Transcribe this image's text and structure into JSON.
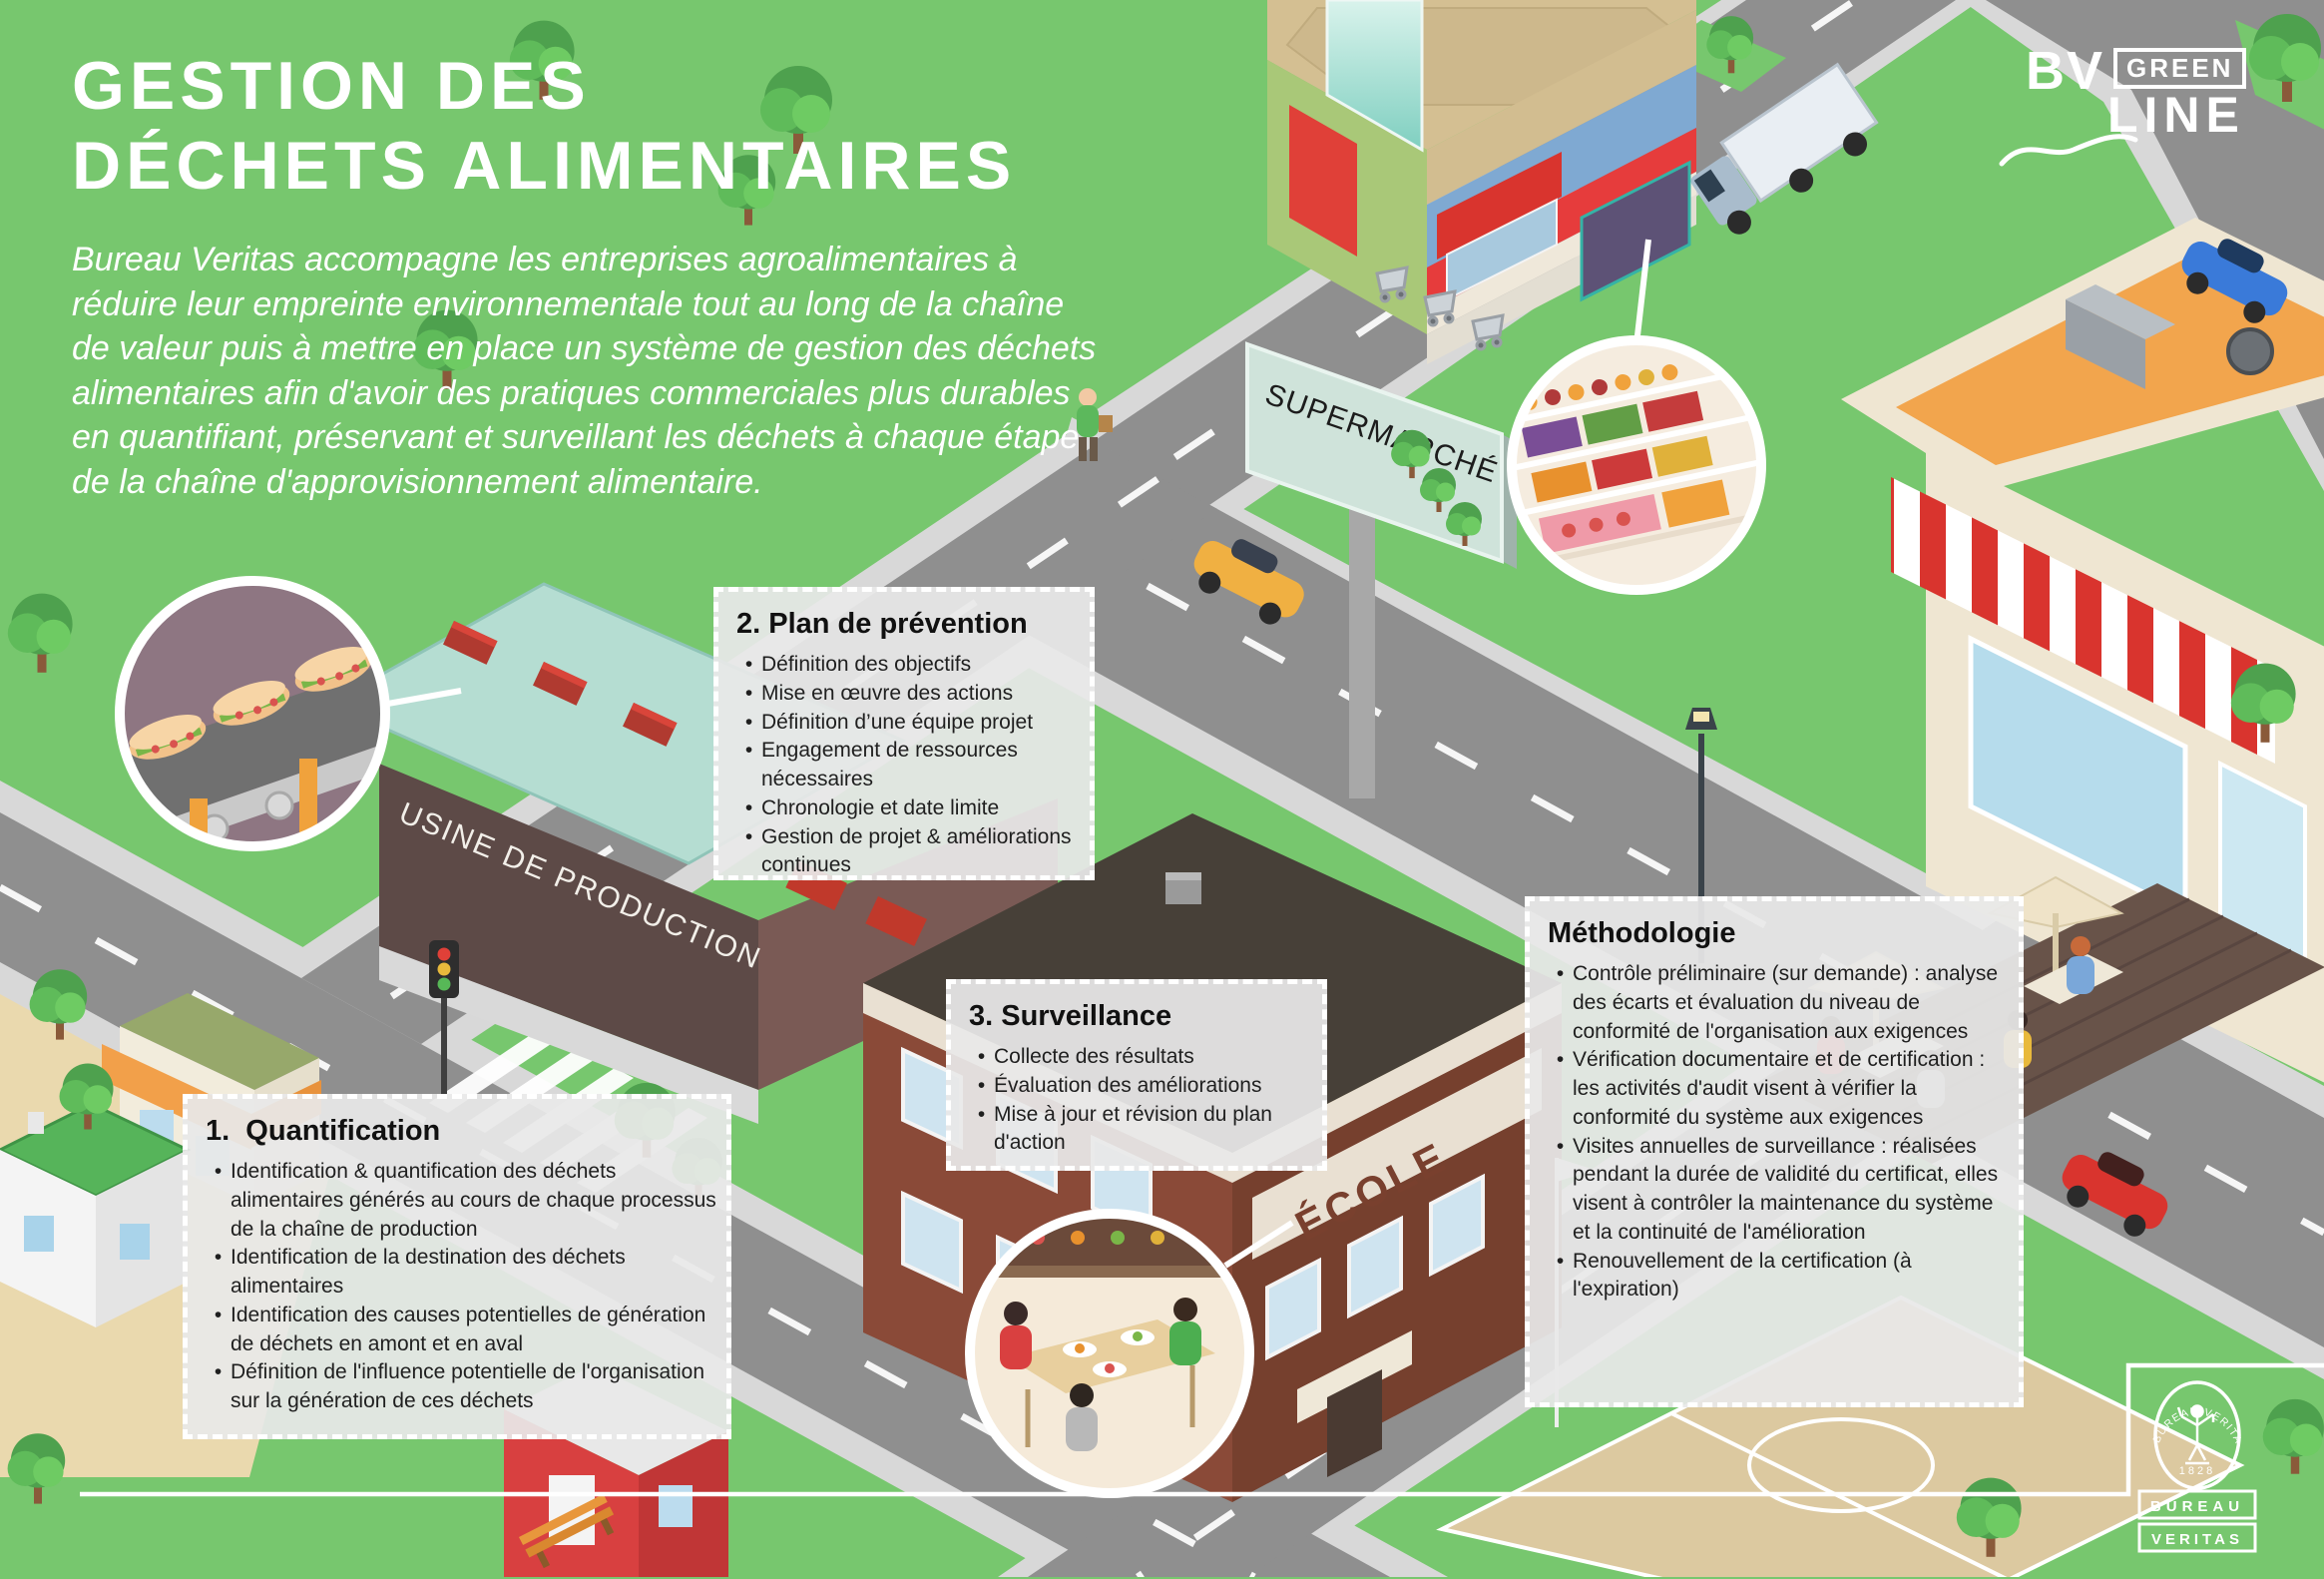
{
  "title": {
    "line1": "GESTION DES",
    "line2": "DÉCHETS ALIMENTAIRES"
  },
  "intro": "Bureau Veritas accompagne les entreprises agroalimentaires à réduire leur empreinte environnementale tout au long de la chaîne de valeur puis à mettre en place un système de gestion des déchets alimentaires afin d'avoir des pratiques commerciales plus durables en quantifiant, préservant et surveillant les déchets à chaque étape de la chaîne d'approvisionnement alimentaire.",
  "boxes": {
    "quantification": {
      "title": "1.  Quantification",
      "bullets": [
        "Identification & quantification des déchets alimentaires générés au cours de chaque processus de la chaîne de production",
        "Identification de la destination des déchets alimentaires",
        "Identification des causes potentielles de génération de déchets en amont et en aval",
        "Définition de l'influence potentielle de l'organisation sur la génération de ces déchets"
      ]
    },
    "prevention": {
      "title": "2. Plan de prévention",
      "bullets": [
        "Définition des objectifs",
        "Mise en œuvre des actions",
        "Définition d’une équipe projet",
        "Engagement de ressources nécessaires",
        "Chronologie et date limite",
        "Gestion de projet & améliorations continues"
      ]
    },
    "surveillance": {
      "title": "3. Surveillance",
      "bullets": [
        "Collecte des résultats",
        "Évaluation des améliorations",
        "Mise à jour et révision du plan d'action"
      ]
    },
    "methodologie": {
      "title": "Méthodologie",
      "bullets": [
        "Contrôle préliminaire (sur demande) : analyse des écarts et évaluation du niveau de conformité de l'organisation aux exigences",
        "Vérification documentaire et de certification : les activités d'audit visent à vérifier la conformité du système aux exigences",
        "Visites annuelles de surveillance : réalisées pendant la durée de validité du certificat, elles visent à contrôler la maintenance du système et la continuité de l'amélioration",
        "Renouvellement de la certification (à l'expiration)"
      ]
    }
  },
  "labels": {
    "supermarket": "SUPERMARCHÉ",
    "factory": "USINE DE PRODUCTION",
    "school": "ÉCOLE"
  },
  "brand": {
    "bv": "BV",
    "green": "GREEN",
    "line": "LINE"
  },
  "logo": {
    "arc": "BUREAU VERITAS",
    "year": "1828",
    "box1": "BUREAU",
    "box2": "VERITAS"
  },
  "colors": {
    "background_green": "#77c76e",
    "road_gray": "#8f8f8f",
    "sidewalk_gray": "#d8d8d8",
    "accent_red": "#e63c3c",
    "brick_brown": "#8a4a38",
    "factory_brown": "#5d4a47",
    "supermarket_tan": "#d2bd90",
    "cafe_orange": "#f2a54d",
    "text_white": "#ffffff",
    "box_background": "#e8e8e8"
  }
}
